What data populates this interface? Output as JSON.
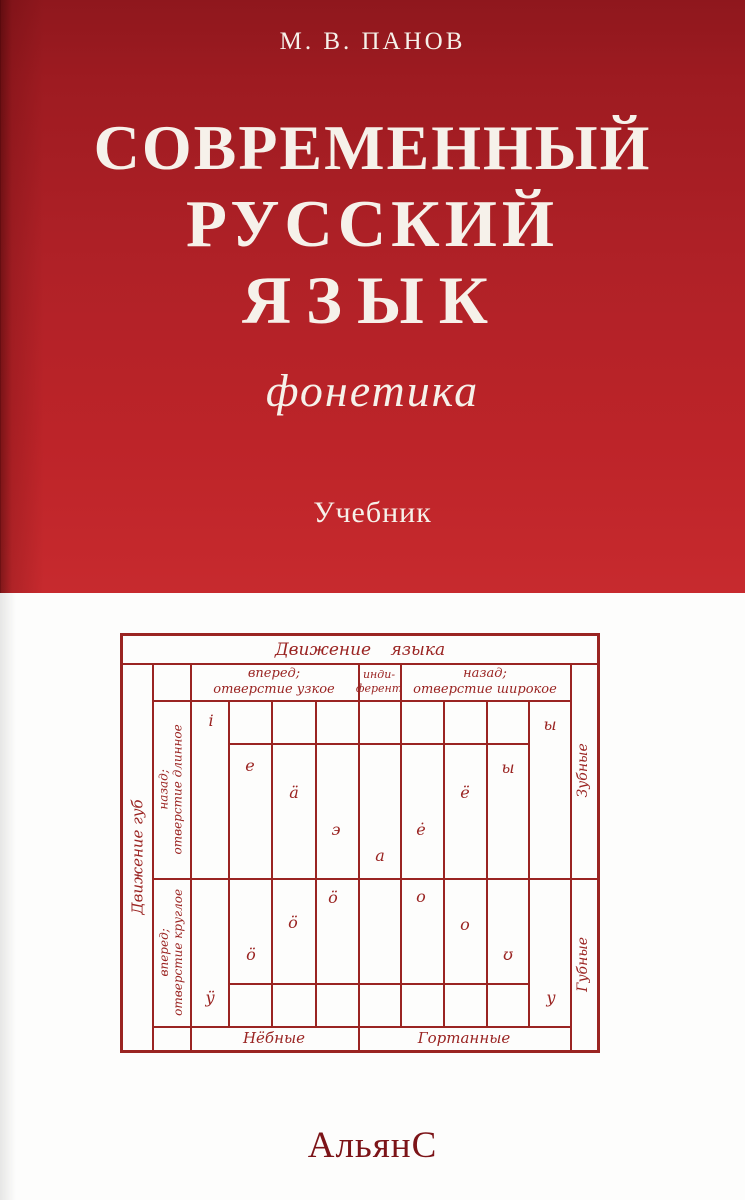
{
  "cover": {
    "author": "М. В. ПАНОВ",
    "title": [
      "СОВРЕМЕННЫЙ",
      "РУССКИЙ",
      "ЯЗЫК"
    ],
    "subtitle": "фонетика",
    "edition_type": "Учебник",
    "publisher": "АльянС",
    "colors": {
      "cover_red": "#b02127",
      "diagram_ink": "#9a2422",
      "publisher_ink": "#7c1418",
      "title_text": "#f6f1ea"
    }
  },
  "diagram": {
    "title": "Движение языка",
    "left_axis": "Движение губ",
    "columns": {
      "front": [
        "вперед;",
        "отверстие узкое"
      ],
      "indifferent": [
        "инди-",
        "ферент"
      ],
      "back": [
        "назад;",
        "отверстие широкое"
      ]
    },
    "rows": {
      "spread": [
        "назад;",
        "отверстие длинное"
      ],
      "rounded": [
        "вперед;",
        "отверстие круглое"
      ]
    },
    "right_labels": {
      "top": "Зубные",
      "bottom": "Губные"
    },
    "bottom_labels": {
      "palatal": "Нёбные",
      "guttural": "Гортанные"
    },
    "vowels": [
      {
        "glyph": "i",
        "x": 88,
        "y": 85
      },
      {
        "glyph": "ы",
        "x": 427,
        "y": 89
      },
      {
        "glyph": "е",
        "x": 127,
        "y": 130
      },
      {
        "glyph": "ы",
        "x": 385,
        "y": 132
      },
      {
        "glyph": "ä",
        "x": 171,
        "y": 157
      },
      {
        "glyph": "ё",
        "x": 342,
        "y": 157
      },
      {
        "glyph": "э",
        "x": 213,
        "y": 194
      },
      {
        "glyph": "ė",
        "x": 298,
        "y": 194
      },
      {
        "glyph": "а",
        "x": 257,
        "y": 220
      },
      {
        "glyph": "ӧ",
        "x": 210,
        "y": 262
      },
      {
        "glyph": "о",
        "x": 298,
        "y": 261
      },
      {
        "glyph": "ö",
        "x": 170,
        "y": 287
      },
      {
        "glyph": "о",
        "x": 342,
        "y": 289
      },
      {
        "glyph": "ö",
        "x": 128,
        "y": 319
      },
      {
        "glyph": "ʊ",
        "x": 385,
        "y": 319
      },
      {
        "glyph": "ÿ",
        "x": 87,
        "y": 362
      },
      {
        "glyph": "у",
        "x": 428,
        "y": 362
      }
    ]
  }
}
